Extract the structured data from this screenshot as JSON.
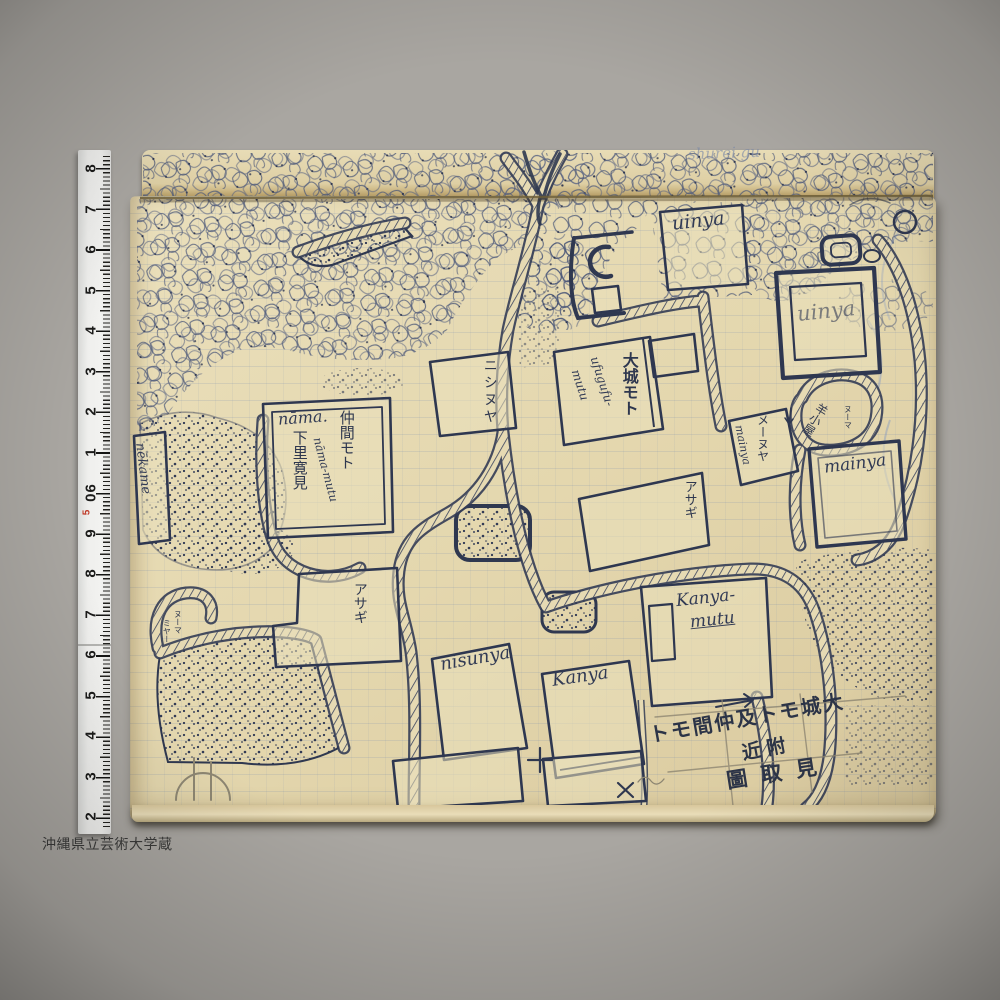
{
  "credit": "沖縄県立芸術大学蔵",
  "colors": {
    "ink": "#2f3850",
    "paper": "#e6dab2",
    "ruler_red": "#c03a28",
    "background": "#a9a6a1"
  },
  "ruler": {
    "numbers": [
      "8",
      "7",
      "6",
      "5",
      "4",
      "3",
      "2",
      "1",
      "60",
      "5",
      "9",
      "8",
      "7",
      "6",
      "5",
      "4",
      "3",
      "2"
    ]
  },
  "map": {
    "note_faint": "shurei gu",
    "title": {
      "line1": "トモ間仲及トモ城大",
      "line2": "近附",
      "line3": "圖取見"
    },
    "labels": {
      "uinya_top": "uinya",
      "uinya_right": "uinya",
      "nishinuya": "ニシヌヤ",
      "ooshiro_moto": "大城モト",
      "ufugufu_line1": "ufugufu-",
      "ufugufu_line2": "mutu",
      "naama": "nāma.",
      "nakama_moto": "仲間モト",
      "naama_mutu": "nāma-mutu",
      "shimozato_kenmi": "下里寛見",
      "nekame": "nēkame",
      "meenuya": "メーヌヤ",
      "meenuya_cursive": "mainya",
      "hitsuji_goya": "羊小屋",
      "nuuma_small": "ヌーマ",
      "mainya": "mainya",
      "asagi_center": "アサギ",
      "asagi_left": "アサギ",
      "nuuma_left": "ヌーマ",
      "miyaa_left": "ミヤー",
      "nisunya": "nisunya",
      "kanya": "Kanya",
      "kanya_mutu_line1": "Kanya-",
      "kanya_mutu_line2": "mutu"
    }
  }
}
